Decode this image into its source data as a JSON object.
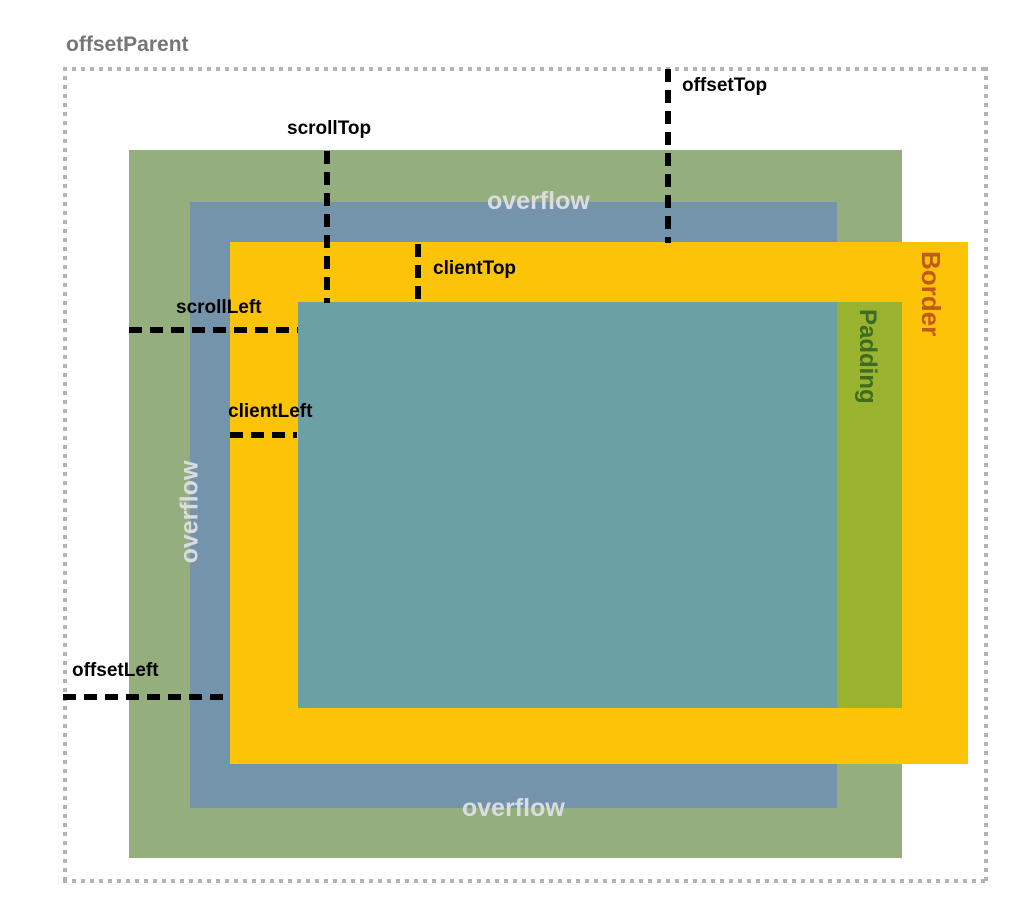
{
  "labels": {
    "offset_parent": "offsetParent",
    "offset_top": "offsetTop",
    "scroll_top": "scrollTop",
    "client_top": "clientTop",
    "scroll_left": "scrollLeft",
    "client_left": "clientLeft",
    "offset_left": "offsetLeft",
    "overflow_top": "overflow",
    "overflow_left": "overflow",
    "overflow_bottom": "overflow",
    "border": "Border",
    "padding": "Padding"
  },
  "colors": {
    "outer_green": "#95ae7d",
    "scroll_blue": "#7494ac",
    "border_orange": "#fdc306",
    "content_teal": "#6ba1a4",
    "padding_green": "#99b32e",
    "border_text": "#bf5a17",
    "padding_text": "#3e6b1f",
    "overflow_text": "#d9dde1",
    "offset_parent_text": "#767676",
    "dotted_border": "#b3b3b3",
    "dash_black": "#000000"
  }
}
